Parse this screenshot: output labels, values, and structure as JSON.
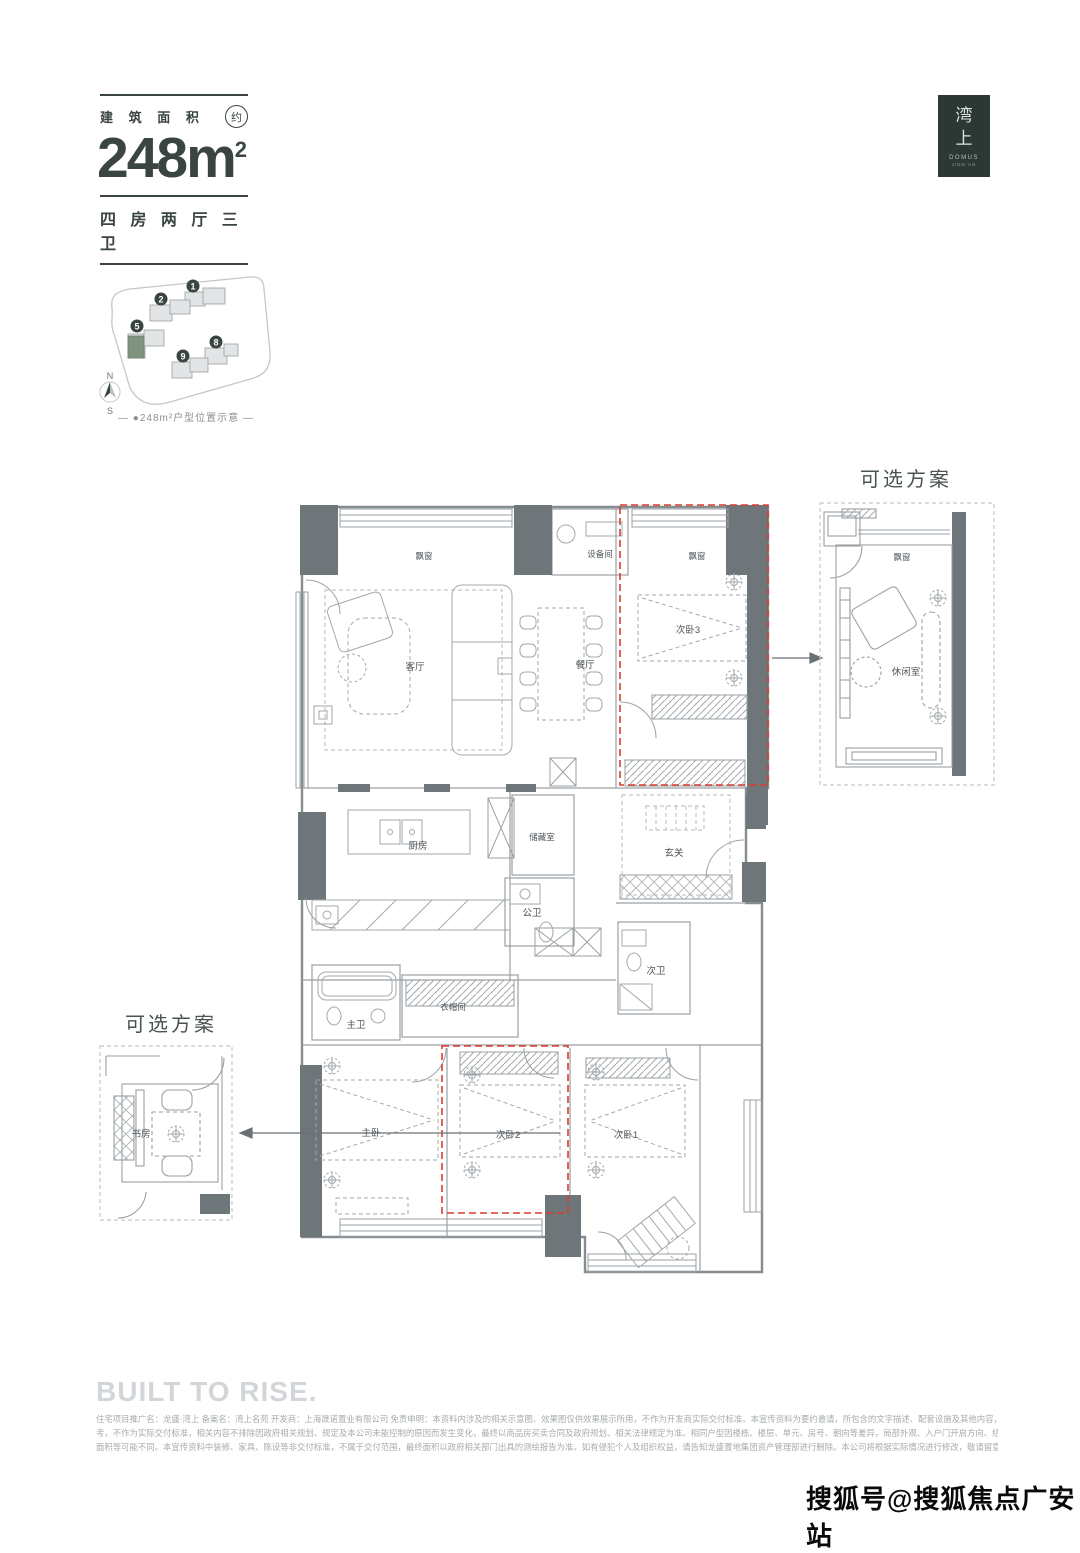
{
  "header": {
    "area_label": "建 筑 面 积",
    "area_approx": "约",
    "area_value": "248m",
    "area_sup": "2",
    "unit_layout": "四 房 两 厅 三 卫"
  },
  "logo": {
    "hanzi_top": "湾",
    "hanzi_bottom": "上",
    "latin1": "DOMUS",
    "latin2": "JING AN"
  },
  "site_plan": {
    "caption": "— ●248m²户型位置示意 —",
    "compass": {
      "north": "N",
      "south": "S"
    },
    "building_numbers": [
      "1",
      "2",
      "5",
      "8",
      "9"
    ],
    "highlight_color": "#7f937f"
  },
  "floor_plan": {
    "labels": {
      "bay_window": "飘窗",
      "equipment": "设备间",
      "living": "客厅",
      "dining": "餐厅",
      "bedroom3": "次卧3",
      "kitchen": "厨房",
      "storage": "储藏室",
      "guest_bath": "公卫",
      "foyer": "玄关",
      "sec_bath": "次卫",
      "master_bath": "主卫",
      "closet": "衣帽间",
      "master_bed": "主卧",
      "bedroom2": "次卧2",
      "bedroom1": "次卧1"
    },
    "highlight_red": "#dc3a2c"
  },
  "optional_plan_right": {
    "title": "可选方案",
    "room": "休闲室",
    "bay_window": "飘窗"
  },
  "optional_plan_left": {
    "title": "可选方案",
    "room": "书房"
  },
  "footer": {
    "slogan": "BUILT TO RISE.",
    "disclaimer_lines": [
      "住宅项目推广名：龙盛·湾上 备案名：湾上名苑 开发商：上海晟诺置业有限公司 免责申明：本资料内涉及的相关示意图、效果图仅供效果展示所用，不作为开发商实际交付标准。本宣传资料为要约邀请，所包含的文字描述、配套设施及其他内容，仅供参",
      "考，不作为实际交付标准，相关内容不排除因政府相关规划、规定及本公司未能控制的原因而发生变化，最终以商品房买卖合同及政府规划、相关法律规定为准。相同户型因楼栋、楼层、单元、房号、朝向等差异，局部外观、入户门开启方向、结构、管道、尺寸、",
      "面积等可能不同。本宣传资料中装修、家具、陈设等非交付标准，不属于交付范围，最终面积以政府相关部门出具的测绘报告为准。如有侵犯个人及组织权益，请告知龙盛置地集团资产管理部进行删除。本公司将根据实际情况进行修改，敬请留意最新资料。"
    ]
  },
  "watermark": "搜狐号@搜狐焦点广安站"
}
